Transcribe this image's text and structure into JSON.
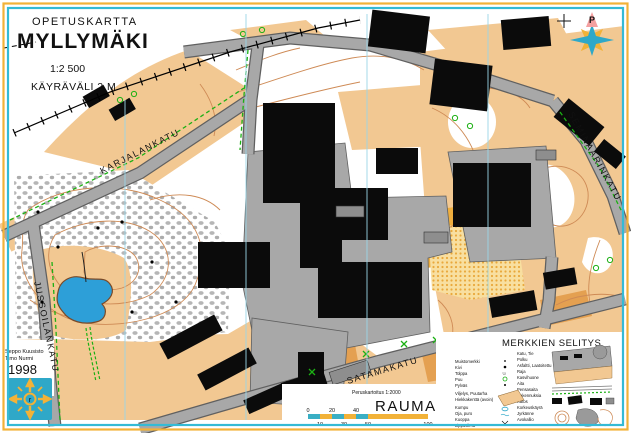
{
  "title_block": {
    "category": "OPETUSKARTTA",
    "title": "MYLLYMÄKI",
    "scale": "1:2 500",
    "contour_interval": "KÄYRÄVÄLI 2 M"
  },
  "compass": {
    "north_label": "P"
  },
  "streets": {
    "karjalankatu": "KARJALANKATU",
    "seminaarinkatu": "SEMINAARINKATU",
    "satamakatu": "SATAMAKATU",
    "jussoilankatu": "JUSSOILANKATU"
  },
  "credits": {
    "line1": "Seppo Kuusisto",
    "line2": "Timo Nurmi",
    "year": "1998"
  },
  "footer": {
    "base_map_note": "Peruskartoitus 1:2000",
    "city": "RAUMA"
  },
  "scale_bar": {
    "top_labels": [
      "0",
      "20",
      "40"
    ],
    "bottom_labels": [
      "10",
      "30",
      "50",
      "100"
    ]
  },
  "legend": {
    "title": "MERKKIEN SELITYS",
    "left_items": [
      "Muistomerkki",
      "Kivi",
      "Tolppa",
      "Puu",
      "Pylväs",
      "Viljelys, Puutarha",
      "Hiekkakenttä (avoin)",
      "Kumpu",
      "Oja, puro",
      "Kuoppa",
      "Lippusiima"
    ],
    "right_items": [
      "Katu, Tie",
      "Polku",
      "Asfaltti, Laatoitettu",
      "Raja",
      "Kasvihuone",
      "Aita",
      "Pensasaita",
      "Rakennuksia",
      "Katos",
      "Korkeuskäyrä",
      "Jyrkänne",
      "Avokallio"
    ]
  },
  "colors": {
    "frame_outer": "#F2B238",
    "frame_inner": "#35BAD5",
    "open_land_tan": "#F2C892",
    "open_land_dark": "#E4A051",
    "field_yellow": "#EFAE3E",
    "road_gray": "#A8A8A8",
    "building_black": "#0B0B0B",
    "pond_blue": "#2D9FD8",
    "contour_brown": "#CE8A55",
    "vegetation_green": "#1CB014",
    "grid_blue": "#9AD6E8",
    "city_text": "#BE7A1E"
  }
}
